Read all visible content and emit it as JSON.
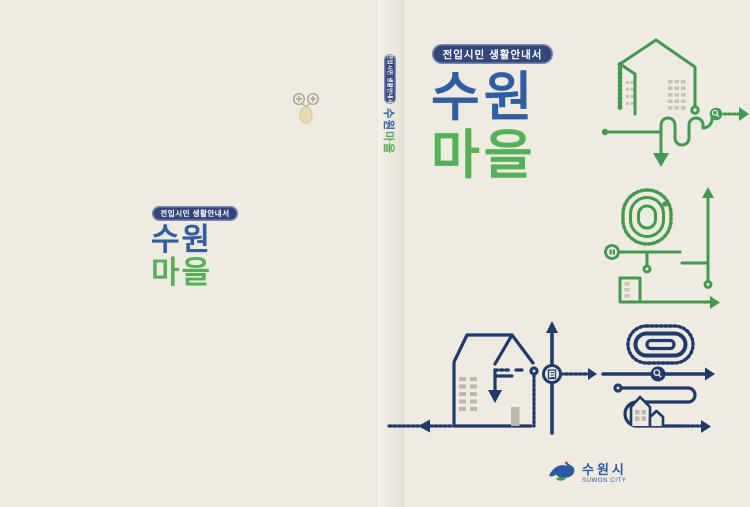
{
  "colors": {
    "background": "#efebe1",
    "title_blue": "#2d5fa8",
    "title_green": "#53b257",
    "badge_navy": "#33477e",
    "illustration_green": "#3f9c4d",
    "illustration_navy": "#1e3a6e",
    "logo_blue": "#2b59a7"
  },
  "front_cover": {
    "badge_label": "전입시민 생활안내서",
    "title_top": "수원",
    "title_bottom": "마을"
  },
  "back_cover": {
    "badge_label": "전입시민 생활안내서",
    "title_top": "수원",
    "title_bottom": "마을"
  },
  "spine": {
    "badge_label": "전입시민 생활안내서",
    "title_top": "수원",
    "title_bottom": "마을"
  },
  "logo": {
    "korean": "수원시",
    "english": "SUWON CITY"
  }
}
